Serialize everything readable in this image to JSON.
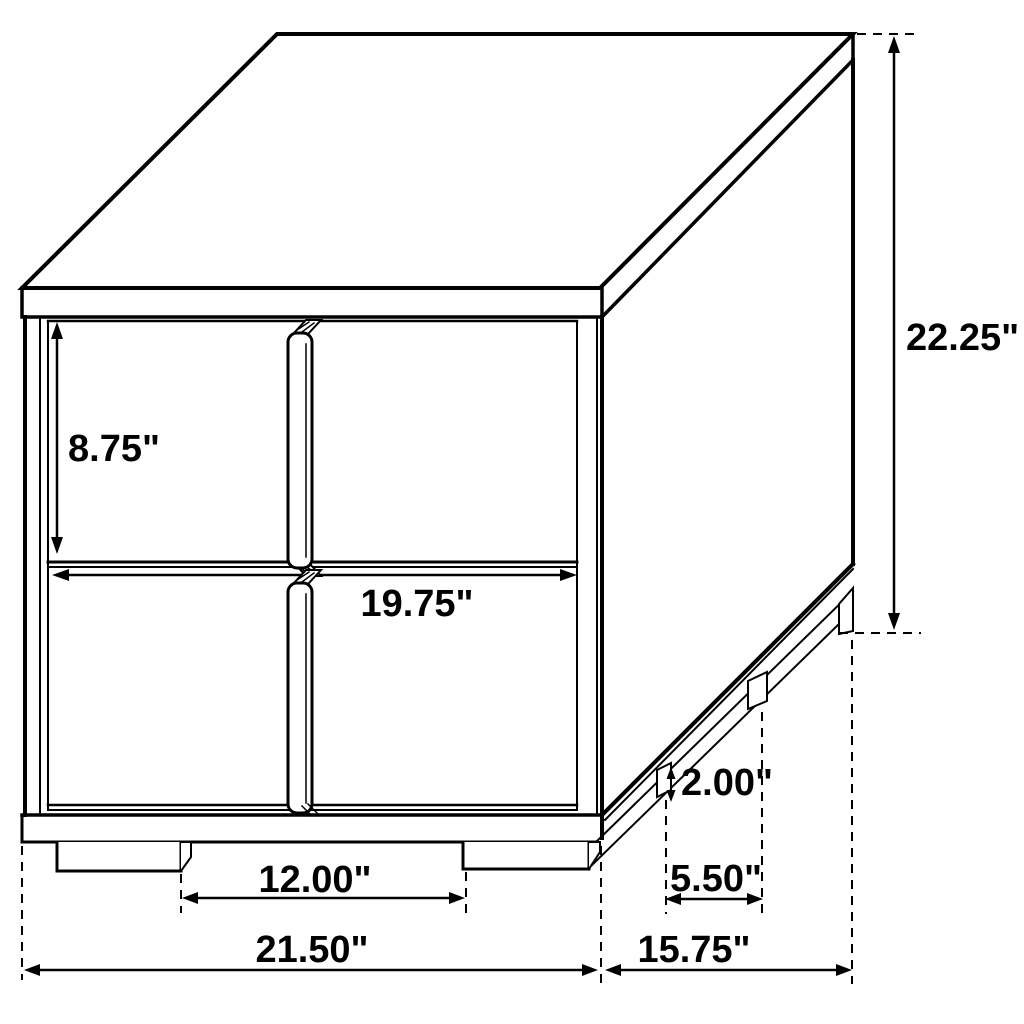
{
  "diagram": {
    "description": "Technical line drawing of a two-drawer nightstand with dimension callouts",
    "unit": "inches",
    "colors": {
      "line": "#000000",
      "background": "#ffffff"
    },
    "labels": {
      "drawer_front_height": "8.75\"",
      "drawer_front_width": "19.75\"",
      "overall_height": "22.25\"",
      "foot_height": "2.00\"",
      "side_foot_spacing": "5.50\"",
      "front_leg_spacing": "12.00\"",
      "overall_width": "21.50\"",
      "overall_depth": "15.75\""
    }
  }
}
